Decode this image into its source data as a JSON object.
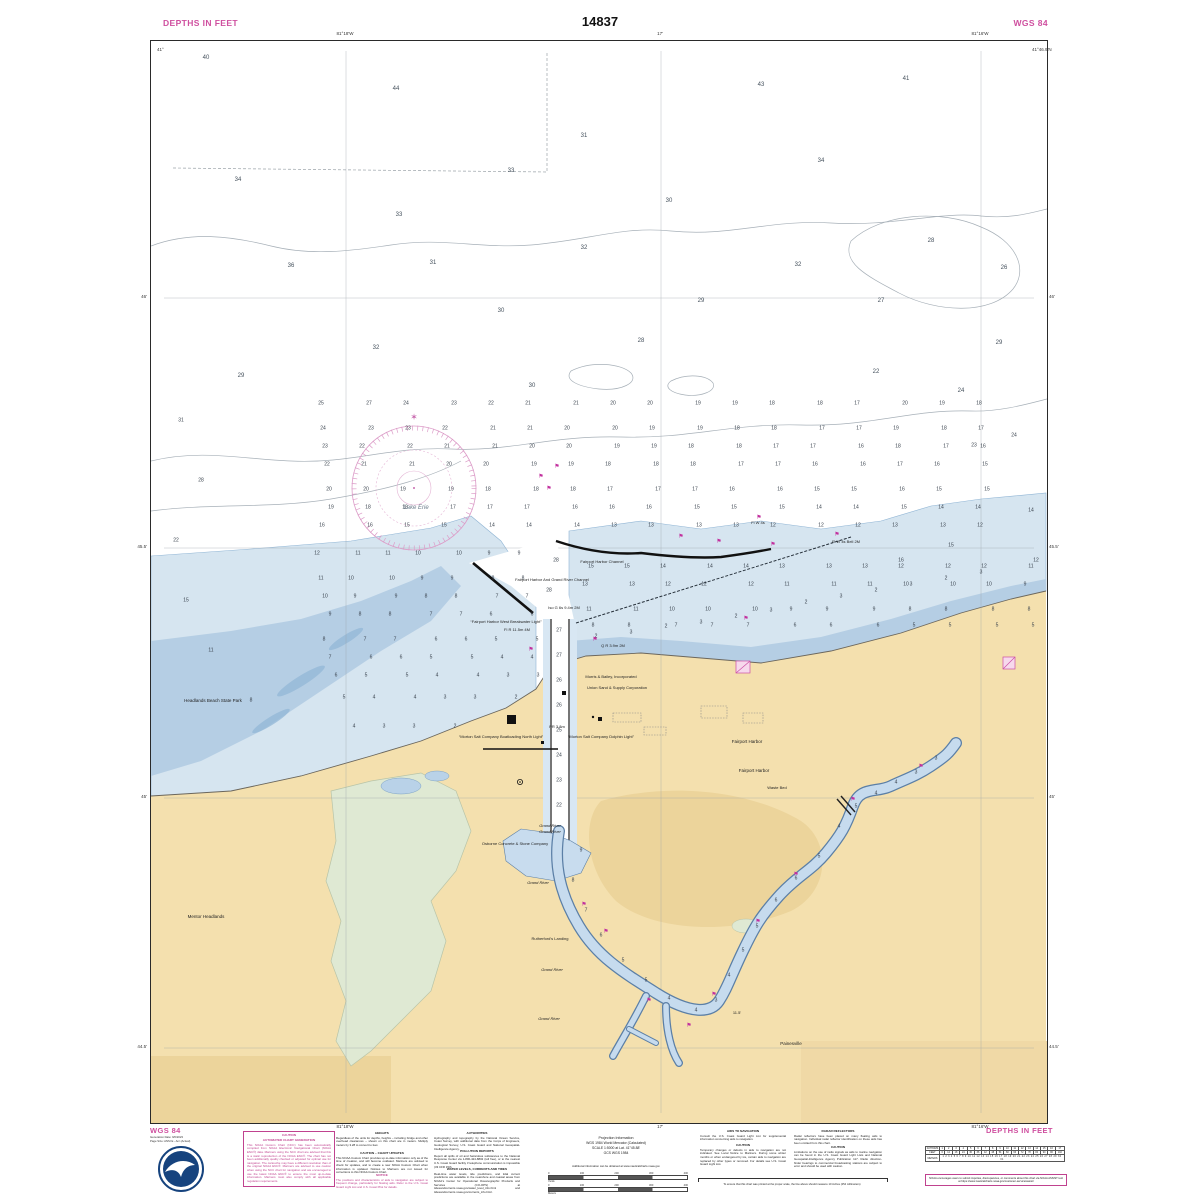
{
  "header": {
    "left": "DEPTHS IN FEET",
    "center": "14837",
    "right": "WGS 84"
  },
  "footer": {
    "left": "WGS 84",
    "right": "DEPTHS IN FEET"
  },
  "colors": {
    "magenta_title": "#cf4f9f",
    "magenta_symbol": "#c2309e",
    "land_buff": "#f4e0ae",
    "land_dark": "#ecd49b",
    "shallow_pale": "#d6e5f0",
    "shallow_mid": "#b5cee4",
    "marsh_green": "#dfe9d3",
    "contour_gray": "#a7b0b8",
    "sounding_gray": "#39424d"
  },
  "map": {
    "lake_label": "Lake Erie",
    "place_labels": [
      {
        "t": "Lake Erie",
        "x": 415,
        "y": 507,
        "s": 6,
        "c": "#6a7b8a",
        "i": 1
      },
      {
        "t": "Fairport Harbor Channel",
        "x": 601,
        "y": 561,
        "s": 4
      },
      {
        "t": "Fairport Harbor And Grand River Channel",
        "x": 551,
        "y": 579,
        "s": 4
      },
      {
        "t": "Iso G 6s 9.4m 2M",
        "x": 563,
        "y": 607,
        "s": 4
      },
      {
        "t": "“Fairport Harbor West Breakwater Light”",
        "x": 505,
        "y": 621,
        "s": 4
      },
      {
        "t": "Fl R 11.5m 4M",
        "x": 516,
        "y": 629,
        "s": 4
      },
      {
        "t": "Q R 3.9m 2M",
        "x": 612,
        "y": 645,
        "s": 4
      },
      {
        "t": "Fl W 4s",
        "x": 757,
        "y": 522,
        "s": 4
      },
      {
        "t": "Fl W 4s Bell 2M",
        "x": 845,
        "y": 541,
        "s": 4
      },
      {
        "t": "Morris & Bailey, Incorporated",
        "x": 610,
        "y": 676,
        "s": 4
      },
      {
        "t": "Union Sand & Supply Corporation",
        "x": 616,
        "y": 687,
        "s": 4
      },
      {
        "t": "Headlands Beach State Park",
        "x": 212,
        "y": 700,
        "s": 4.5
      },
      {
        "t": "“Morton Salt Company Boatloading North Light”",
        "x": 500,
        "y": 736,
        "s": 4
      },
      {
        "t": "“Morton Salt Company Dolphin Light”",
        "x": 600,
        "y": 736,
        "s": 4
      },
      {
        "t": "PR 3.8m",
        "x": 556,
        "y": 726,
        "s": 4
      },
      {
        "t": "Fairport Harbor",
        "x": 746,
        "y": 741,
        "s": 4.5
      },
      {
        "t": "Fairport Harbor",
        "x": 753,
        "y": 770,
        "s": 4.5
      },
      {
        "t": "Waste Bed",
        "x": 776,
        "y": 787,
        "s": 4
      },
      {
        "t": "Grand River",
        "x": 549,
        "y": 825,
        "s": 4,
        "i": 1
      },
      {
        "t": "Grand River",
        "x": 549,
        "y": 831,
        "s": 4,
        "i": 1
      },
      {
        "t": "Osborne Concrete & Stone Company",
        "x": 514,
        "y": 843,
        "s": 4
      },
      {
        "t": "Grand River",
        "x": 537,
        "y": 882,
        "s": 4,
        "i": 1
      },
      {
        "t": "Rutherford's Landing",
        "x": 549,
        "y": 938,
        "s": 4
      },
      {
        "t": "Grand River",
        "x": 551,
        "y": 969,
        "s": 4,
        "i": 1
      },
      {
        "t": "Grand River",
        "x": 548,
        "y": 1018,
        "s": 4,
        "i": 1
      },
      {
        "t": "Mentor Headlands",
        "x": 205,
        "y": 916,
        "s": 4.5
      },
      {
        "t": "Painesville",
        "x": 790,
        "y": 1043,
        "s": 4.5
      },
      {
        "t": "11.5'",
        "x": 736,
        "y": 1012,
        "s": 4
      }
    ],
    "sounding_rows": [
      {
        "y": 406,
        "x0": 325,
        "dx": 41,
        "v": [
          25,
          27,
          24,
          23,
          22,
          21,
          21,
          20,
          20,
          19,
          19,
          18,
          18,
          17,
          20,
          19,
          18
        ]
      },
      {
        "y": 426,
        "x0": 325,
        "dx": 41,
        "v": [
          24,
          23,
          23,
          22,
          21,
          21,
          20,
          20,
          19,
          19,
          18,
          18,
          17,
          17,
          19,
          18,
          17
        ]
      },
      {
        "y": 446,
        "x0": 325,
        "dx": 41,
        "v": [
          23,
          22,
          22,
          21,
          21,
          20,
          20,
          19,
          19,
          18,
          18,
          17,
          17,
          16,
          18,
          17,
          16
        ]
      },
      {
        "y": 466,
        "x0": 325,
        "dx": 41,
        "v": [
          22,
          21,
          21,
          20,
          20,
          19,
          19,
          18,
          18,
          18,
          17,
          17,
          16,
          16,
          17,
          16,
          15
        ]
      },
      {
        "y": 486,
        "x0": 325,
        "dx": 41,
        "v": [
          20,
          20,
          19,
          19,
          18,
          18,
          18,
          17,
          17,
          17,
          16,
          16,
          15,
          15,
          16,
          15,
          15
        ]
      },
      {
        "y": 506,
        "x0": 325,
        "dx": 41,
        "v": [
          19,
          18,
          18,
          17,
          17,
          17,
          16,
          16,
          16,
          15,
          15,
          15,
          14,
          14,
          15,
          14,
          14
        ]
      },
      {
        "y": 526,
        "x0": 325,
        "dx": 41,
        "v": [
          16,
          16,
          15,
          15,
          14,
          14,
          14,
          13,
          13,
          13,
          13,
          12,
          12,
          12,
          13,
          13,
          12
        ]
      },
      {
        "y": 556,
        "x0": 318,
        "dx": 34,
        "v": [
          12,
          11,
          11,
          10,
          10,
          9,
          9
        ]
      },
      {
        "y": 576,
        "x0": 320,
        "dx": 34,
        "v": [
          11,
          10,
          10,
          9,
          9,
          8,
          8
        ]
      },
      {
        "y": 596,
        "x0": 322,
        "dx": 34,
        "v": [
          10,
          9,
          9,
          8,
          8,
          7,
          7
        ]
      },
      {
        "y": 616,
        "x0": 325,
        "dx": 34,
        "v": [
          9,
          8,
          8,
          7,
          7,
          6,
          6
        ]
      },
      {
        "y": 636,
        "x0": 328,
        "dx": 34,
        "v": [
          8,
          7,
          7,
          6,
          6,
          5,
          5
        ]
      },
      {
        "y": 656,
        "x0": 332,
        "dx": 34,
        "v": [
          7,
          6,
          6,
          5,
          5,
          4,
          4
        ]
      },
      {
        "y": 676,
        "x0": 336,
        "dx": 34,
        "v": [
          6,
          5,
          5,
          4,
          4,
          3,
          3
        ]
      },
      {
        "y": 700,
        "x0": 342,
        "dx": 34,
        "v": [
          5,
          4,
          4,
          3,
          3,
          2
        ]
      },
      {
        "y": 724,
        "x0": 350,
        "dx": 34,
        "v": [
          4,
          3,
          3,
          2
        ]
      },
      {
        "y": 566,
        "x0": 585,
        "dx": 40,
        "v": [
          15,
          15,
          14,
          14,
          14,
          13,
          13,
          13,
          12,
          12,
          12,
          11
        ]
      },
      {
        "y": 586,
        "x0": 588,
        "dx": 40,
        "v": [
          13,
          13,
          12,
          12,
          12,
          11,
          11,
          11,
          10,
          10,
          10,
          9
        ]
      },
      {
        "y": 606,
        "x0": 590,
        "dx": 40,
        "v": [
          11,
          11,
          10,
          10,
          10,
          9,
          9,
          9,
          8,
          8,
          8,
          8
        ]
      },
      {
        "y": 624,
        "x0": 592,
        "dx": 40,
        "v": [
          8,
          8,
          7,
          7,
          7,
          6,
          6,
          6,
          5,
          5,
          5,
          5
        ]
      }
    ],
    "soundings": [
      [
        205,
        57,
        40
      ],
      [
        395,
        88,
        44
      ],
      [
        760,
        84,
        43
      ],
      [
        905,
        78,
        41
      ],
      [
        583,
        135,
        31
      ],
      [
        820,
        160,
        34
      ],
      [
        237,
        179,
        34
      ],
      [
        510,
        170,
        33
      ],
      [
        668,
        200,
        30
      ],
      [
        398,
        214,
        33
      ],
      [
        290,
        265,
        36
      ],
      [
        432,
        262,
        31
      ],
      [
        583,
        247,
        32
      ],
      [
        797,
        264,
        32
      ],
      [
        930,
        240,
        28
      ],
      [
        1003,
        267,
        26
      ],
      [
        375,
        347,
        32
      ],
      [
        500,
        310,
        30
      ],
      [
        700,
        300,
        29
      ],
      [
        880,
        300,
        27
      ],
      [
        640,
        340,
        28
      ],
      [
        998,
        342,
        29
      ],
      [
        240,
        375,
        29
      ],
      [
        531,
        385,
        30
      ],
      [
        875,
        371,
        22
      ],
      [
        960,
        390,
        24
      ],
      [
        1013,
        435,
        24
      ],
      [
        973,
        445,
        23
      ],
      [
        180,
        420,
        31
      ],
      [
        200,
        480,
        28
      ],
      [
        175,
        540,
        22
      ],
      [
        185,
        600,
        15
      ],
      [
        210,
        650,
        11
      ],
      [
        250,
        700,
        8
      ],
      [
        1030,
        510,
        14
      ],
      [
        1035,
        560,
        12
      ],
      [
        900,
        560,
        16
      ],
      [
        950,
        545,
        15
      ],
      [
        555,
        560,
        28
      ],
      [
        548,
        590,
        28
      ],
      [
        558,
        630,
        27
      ],
      [
        558,
        655,
        27
      ],
      [
        558,
        680,
        26
      ],
      [
        558,
        705,
        26
      ],
      [
        558,
        730,
        25
      ],
      [
        558,
        755,
        24
      ],
      [
        558,
        780,
        23
      ],
      [
        558,
        805,
        22
      ],
      [
        580,
        850,
        9
      ],
      [
        572,
        880,
        8
      ],
      [
        585,
        910,
        7
      ],
      [
        600,
        935,
        6
      ],
      [
        622,
        960,
        5
      ],
      [
        645,
        980,
        5
      ],
      [
        668,
        998,
        4
      ],
      [
        695,
        1010,
        4
      ],
      [
        715,
        1000,
        3
      ],
      [
        728,
        975,
        4
      ],
      [
        742,
        950,
        5
      ],
      [
        756,
        926,
        5
      ],
      [
        775,
        900,
        6
      ],
      [
        795,
        878,
        6
      ],
      [
        818,
        856,
        5
      ],
      [
        838,
        826,
        4
      ],
      [
        855,
        806,
        5
      ],
      [
        875,
        793,
        4
      ],
      [
        895,
        782,
        4
      ],
      [
        915,
        772,
        3
      ],
      [
        935,
        758,
        3
      ],
      [
        595,
        636,
        2
      ],
      [
        630,
        632,
        3
      ],
      [
        665,
        626,
        2
      ],
      [
        700,
        622,
        3
      ],
      [
        735,
        616,
        2
      ],
      [
        770,
        610,
        3
      ],
      [
        805,
        602,
        2
      ],
      [
        840,
        596,
        3
      ],
      [
        875,
        590,
        2
      ],
      [
        910,
        584,
        3
      ],
      [
        945,
        578,
        2
      ],
      [
        980,
        572,
        3
      ]
    ],
    "buoys": [
      [
        548,
        490
      ],
      [
        540,
        478
      ],
      [
        556,
        468
      ],
      [
        718,
        543
      ],
      [
        772,
        546
      ],
      [
        836,
        536
      ],
      [
        758,
        519
      ],
      [
        680,
        538
      ],
      [
        594,
        641
      ],
      [
        530,
        651
      ],
      [
        745,
        620
      ],
      [
        583,
        906
      ],
      [
        605,
        933
      ],
      [
        648,
        1002
      ],
      [
        688,
        1027
      ],
      [
        713,
        996
      ],
      [
        757,
        923
      ],
      [
        795,
        876
      ],
      [
        852,
        801
      ],
      [
        920,
        768
      ]
    ],
    "graticule": {
      "lon": [
        {
          "x": 345,
          "t": "81°18'W"
        },
        {
          "x": 660,
          "t": "17'"
        },
        {
          "x": 980,
          "t": "81°16'W"
        }
      ],
      "lat": [
        {
          "y": 297,
          "t": "46'"
        },
        {
          "y": 547,
          "t": "45.5'"
        },
        {
          "y": 797,
          "t": "45'"
        },
        {
          "y": 1047,
          "t": "44.5'"
        }
      ],
      "corners": [
        {
          "x": 157,
          "y": 47,
          "t": "41°"
        },
        {
          "x": 1032,
          "y": 47,
          "t": "41°46.9'N"
        }
      ]
    }
  },
  "notes": {
    "caution_auto": {
      "hd1": "CAUTION",
      "hd2": "AUTOMATED CHART GENERATION",
      "body": "This NOAA Custom Chart (NCC) has been automatically compiled from NOAA Electronic Navigational Chart (NOAA ENC®) data. Mariners using the NCC chart are advised that this is a static reproduction of the NOAA ENC®. The chart has not been additionally quality checked or adjusted for optimal use for navigation. The cartouche may have a different resolution than of the original NOAA ENC®. Mariners are advised to use caution when using the NCC chart for navigation and are encouraged to use the latest NOAA ENC® to ensure the most up-to-date information. Mariners must also comply with all applicable regulation requirements."
    },
    "heights": {
      "hd": "HEIGHTS",
      "body": "Regardless of the units for depths, heights – including bridge and other overhead clearances – shown on this chart are in meters. Multiply meters by 3.28 to convert to feet."
    },
    "chart_updates": {
      "hd": "CAUTION – CHART UPDATES",
      "body": "This NOAA Custom Chart provides up-to-date information only as of the time of creation, and will become outdated. Mariners are advised to check for updates, and to create a new NOAA Custom Chart when information is updated. Notices to Mariners are not issued for corrections to this NOAA Custom Chart."
    },
    "notice": {
      "hd": "NOTICE",
      "body": "The positions and characteristics of aids to navigation are subject to frequent change, particularly for floating aids. Refer to the U.S. Coast Guard Light List and U.S. Coast Pilot for details."
    },
    "authorities": {
      "hd": "AUTHORITIES",
      "body": "Hydrography and topography by the National Ocean Service, Coast Survey, with additional data from the Corps of Engineers, Geological Survey, U.S. Coast Guard and National Geospatial-Intelligence Agency."
    },
    "pollution": {
      "hd": "POLLUTION REPORTS",
      "body": "Report all spills of oil and hazardous substances to the National Response Center via 1-800-424-8802 (toll free), or to the nearest U.S. Coast Guard facility if telephone communication is impossible (33 CFR 153)."
    },
    "water_levels": {
      "hd": "WATER LEVELS, CURRENTS AND TIDES",
      "body": "Real-time water levels, tide predictions, and tidal current predictions are available in the nearshore and coastal areas from NOAA's Center for Operational Oceanographic Products and Services (CO-OPS) at tidesandcurrents.noaa.gov/water_level_info.html and tidesandcurrents.noaa.gov/currents_info.html."
    },
    "aids": {
      "hd": "AIDS TO NAVIGATION",
      "body": "Consult the U.S. Coast Guard Light List for supplemental information concerning aids to navigation."
    },
    "caution_temp": {
      "hd": "CAUTION",
      "body": "Temporary changes or defects in aids to navigation are not indicated. See Local Notice to Mariners. During some winter months or when endangered by ice, certain aids to navigation are replaced by other types or removed. For details see U.S. Coast Guard Light List."
    },
    "radar": {
      "hd": "RADAR REFLECTORS",
      "body": "Radar reflectors have been placed on many floating aids to navigation. Individual radar reflector identification on these aids has been omitted from this chart."
    },
    "caution_radio": {
      "hd": "CAUTION",
      "body": "Limitations on the use of radio signals as aids to marine navigation can be found in the U.S. Coast Guard Light Lists and National Geospatial-Intelligence Agency Publication 117. Radio direction-finder bearings to commercial broadcasting stations are subject to error and should be used with caution."
    },
    "measure": "To ensure that this chart was printed at the proper scale, the line above should measure 10 inches (254 millimeters)",
    "assist": "NOAA encourages users to submit inquiries, discrepancies, or comments about this chart via NOAA ASSIST tool at https://www.nauticalcharts.noaa.gov/customer-service/assist/"
  },
  "projection": {
    "title": "Projection Information",
    "line1": "WGS 1984 World Mercator (Calculated)",
    "line2": "SCALE 1:5000 at Lat. 41°45.88'",
    "line3": "GCS WGS 1984",
    "link": "Additional information can be obtained at www.nauticalcharts.noaa.gov"
  },
  "scalebar": {
    "yards_title": "Yards",
    "yards": [
      "0",
      "100",
      "200",
      "300",
      "400"
    ],
    "meters_title": "Meters",
    "meters": [
      "0",
      "100",
      "200",
      "300",
      "400"
    ]
  },
  "conversion_table": {
    "rows": [
      "FATHOMS",
      "FEET",
      "METERS"
    ],
    "fathoms": [
      "1",
      "2",
      "3",
      "4",
      "5",
      "6",
      "7",
      "8",
      "9",
      "10",
      "11",
      "12",
      "13",
      "14",
      "15",
      "16",
      "17"
    ],
    "feet": [
      "6",
      "12",
      "18",
      "24",
      "30",
      "36",
      "42",
      "48",
      "54",
      "60",
      "66",
      "72",
      "78",
      "84",
      "90",
      "96",
      "102"
    ],
    "meters": "1 2 3 4 5 6 7 8 9 10 11 12 13 14 15 16 17 18 19 20 21 22 23 24 25 26 27 28 29 30 31"
  },
  "noaa_block": {
    "title": "WGS 84",
    "generation": "Generation Date: 9/6/2023",
    "pagesize": "Page Size: ANSI E - Arc (Actual)",
    "logo": "noaa-logo"
  }
}
